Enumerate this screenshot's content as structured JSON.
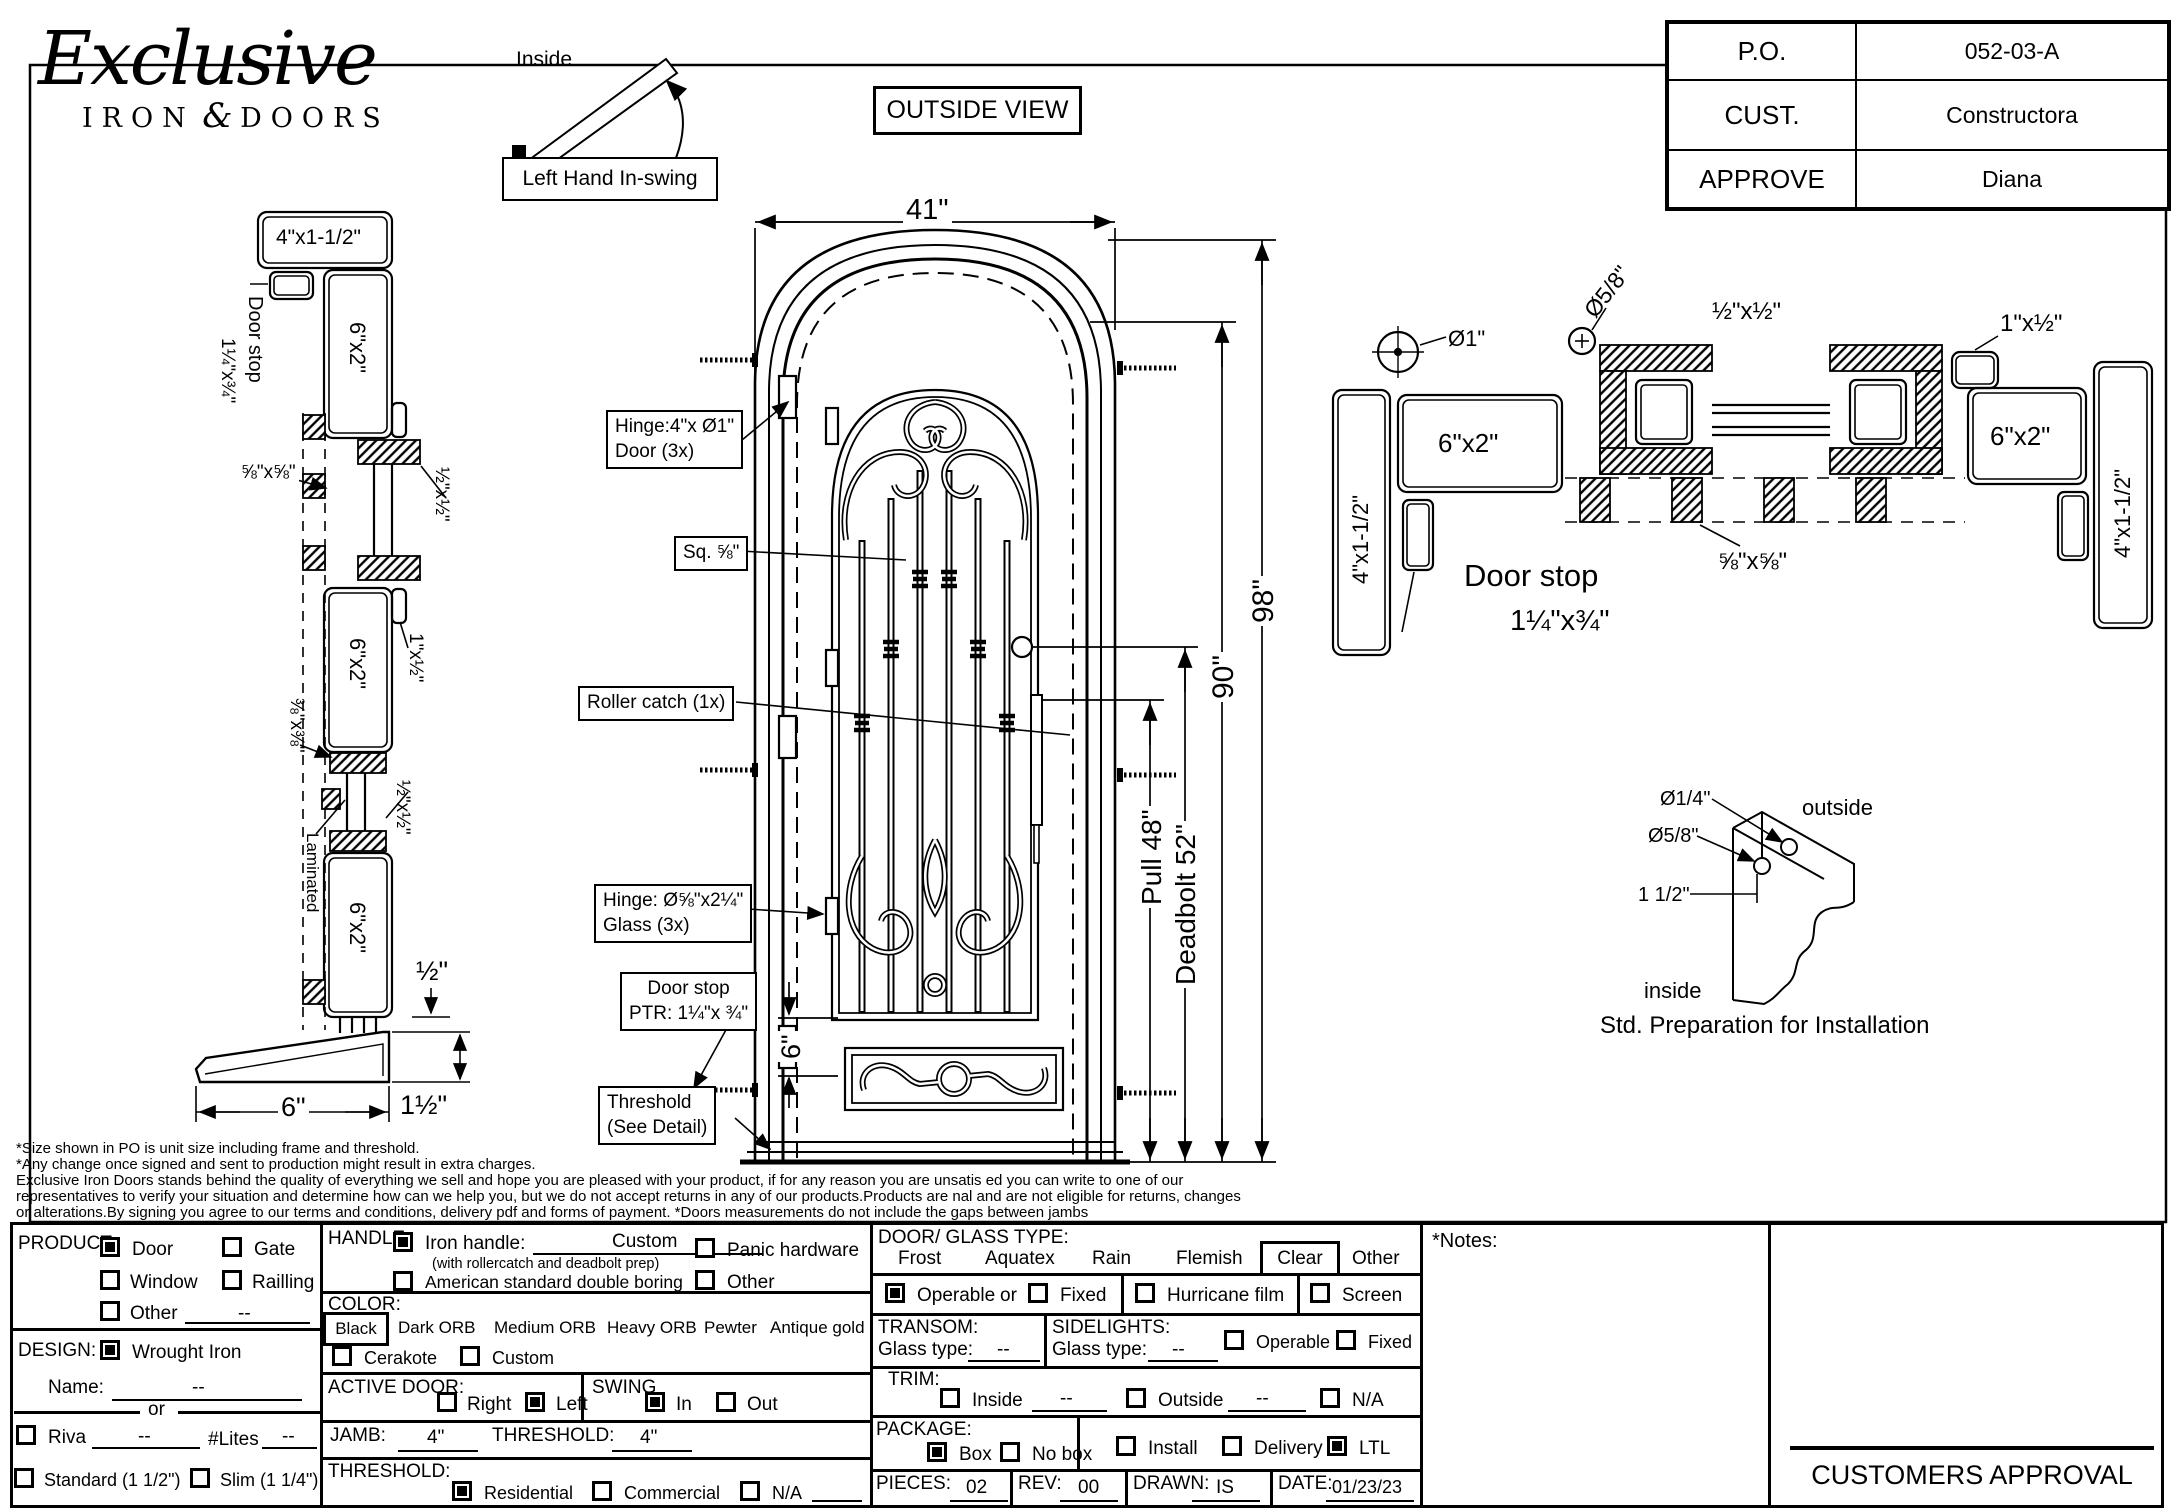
{
  "logo": {
    "script": "Exclusive",
    "iron": "IRON",
    "amp": "&",
    "doors": "DOORS"
  },
  "po": {
    "r1l": "P.O.",
    "r1v": "052-03-A",
    "r2l": "CUST.",
    "r2v": "Constructora",
    "r3l": "APPROVE",
    "r3v": "Diana"
  },
  "swing": {
    "inside": "Inside",
    "outside": "Outside",
    "caption": "Left Hand In-swing",
    "view": "OUTSIDE VIEW"
  },
  "sec": {
    "top": "4\"x1-1/2\"",
    "doorstop": "Door stop",
    "doorstop_size": "1¼\"x¾\"",
    "p1": "6\"x2\"",
    "p2": "6\"x2\"",
    "p3": "6\"x2\"",
    "s58": "⅝\"x⅝\"",
    "s12a": "½\"x½\"",
    "s1x12": "1\"x½\"",
    "s38": "⅜\"x⅜\"",
    "s12b": "½\"x½\"",
    "laminated": "Laminated",
    "d12": "½\"",
    "d6": "6\"",
    "d112": "1½\""
  },
  "door": {
    "w": "41\"",
    "h": "98\"",
    "dh": "90\"",
    "pull": "Pull 48\"",
    "deadbolt": "Deadbolt 52\"",
    "rail": "6\"",
    "c1a": "Hinge:4\"x Ø1\"",
    "c1b": "Door (3x)",
    "c2": "Sq. ⅝\"",
    "c3": "Roller catch  (1x)",
    "c4a": "Hinge: Ø⅝\"x2¼\"",
    "c4b": "Glass (3x)",
    "c5a": "Door stop",
    "c5b": "PTR: 1¼\"x ¾\"",
    "c6a": "Threshold",
    "c6b": "(See Detail)"
  },
  "plan": {
    "d1": "Ø1\"",
    "d58": "Ø5/8\"",
    "s12": "½\"x½\"",
    "s1x12": "1\"x½\"",
    "p1": "6\"x2\"",
    "p2": "6\"x2\"",
    "j1": "4\"x1-1/2\"",
    "j2": "4\"x1-1/2\"",
    "s58": "⅝\"x⅝\"",
    "doorstop": "Door stop",
    "doorstop_size": "1¼\"x¾\""
  },
  "detail": {
    "d14": "Ø1/4\"",
    "d58": "Ø5/8\"",
    "d112": "1 1/2\"",
    "outside": "outside",
    "inside": "inside",
    "caption": "Std. Preparation for Installation"
  },
  "disc": {
    "l1": "*Size shown in PO is unit size including frame and threshold.",
    "l2": "*Any change once signed and sent to production might result in extra charges.",
    "l3": "Exclusive Iron Doors stands behind the quality of everything we sell and hope you are pleased with your product, if for any reason you are unsatis   ed you can write to one of our",
    "l4": "representatives to verify your situation and determine how can we help you, but we do not accept returns in any of our products.Products are    nal and are not eligible for returns, changes",
    "l5": "or alterations.By signing you agree to our terms and conditions, delivery pdf and forms of payment. *Doors measurements do not include the gaps between jambs"
  },
  "form": {
    "product": {
      "label": "PRODUCT:",
      "door": "Door",
      "gate": "Gate",
      "window": "Window",
      "railing": "Railling",
      "other": "Other",
      "other_value": "--"
    },
    "design": {
      "label": "DESIGN:",
      "wrought": "Wrought Iron",
      "name_label": "Name:",
      "name_value": "--",
      "or": "or",
      "riva": "Riva",
      "riva_value": "--",
      "lites": "#Lites",
      "lites_value": "--",
      "standard": "Standard (1 1/2\")",
      "slim": "Slim (1 1/4\")"
    },
    "handle": {
      "label": "HANDLE:",
      "iron": "Iron handle:",
      "iron_value": "Custom",
      "note": "(with rollercatch and deadbolt prep)",
      "american": "American standard double boring",
      "panic": "Panic hardware",
      "other": "Other"
    },
    "color": {
      "label": "COLOR:",
      "black": "Black",
      "dark": "Dark ORB",
      "medium": "Medium ORB",
      "heavy": "Heavy ORB",
      "pewter": "Pewter",
      "antique": "Antique gold",
      "cerakote": "Cerakote",
      "custom": "Custom"
    },
    "active": {
      "label": "ACTIVE DOOR:",
      "right": "Right",
      "left": "Left"
    },
    "swing": {
      "label": "SWING",
      "sw_in": "In",
      "sw_out": "Out"
    },
    "jamb": {
      "label": "JAMB:",
      "value": "4\"",
      "t_label": "THRESHOLD:",
      "t_value": "4\""
    },
    "threshold": {
      "label": "THRESHOLD:",
      "residential": "Residential",
      "commercial": "Commercial",
      "na": "N/A"
    },
    "glass": {
      "label": "DOOR/ GLASS TYPE:",
      "frost": "Frost",
      "aquatex": "Aquatex",
      "rain": "Rain",
      "flemish": "Flemish",
      "clear": "Clear",
      "other": "Other",
      "operable": "Operable",
      "or": "or",
      "fixed": "Fixed",
      "hurricane": "Hurricane film",
      "screen": "Screen"
    },
    "transom": {
      "label": "TRANSOM:",
      "glass_label": "Glass type:",
      "value": "--"
    },
    "sidelights": {
      "label": "SIDELIGHTS:",
      "glass_label": "Glass type:",
      "value": "--",
      "operable": "Operable",
      "fixed": "Fixed"
    },
    "trim": {
      "label": "TRIM:",
      "inside": "Inside",
      "inside_value": "--",
      "outside": "Outside",
      "outside_value": "--",
      "na": "N/A"
    },
    "package": {
      "label": "PACKAGE:",
      "box": "Box",
      "nobox": "No box",
      "install": "Install",
      "delivery": "Delivery",
      "ltl": "LTL"
    },
    "pieces": {
      "label": "PIECES:",
      "value": "02"
    },
    "rev": {
      "label": "REV:",
      "value": "00"
    },
    "drawn": {
      "label": "DRAWN:",
      "value": "IS"
    },
    "date": {
      "label": "DATE:",
      "value": "01/23/23"
    },
    "notes": {
      "label": "*Notes:"
    }
  },
  "approval": "CUSTOMERS APPROVAL"
}
